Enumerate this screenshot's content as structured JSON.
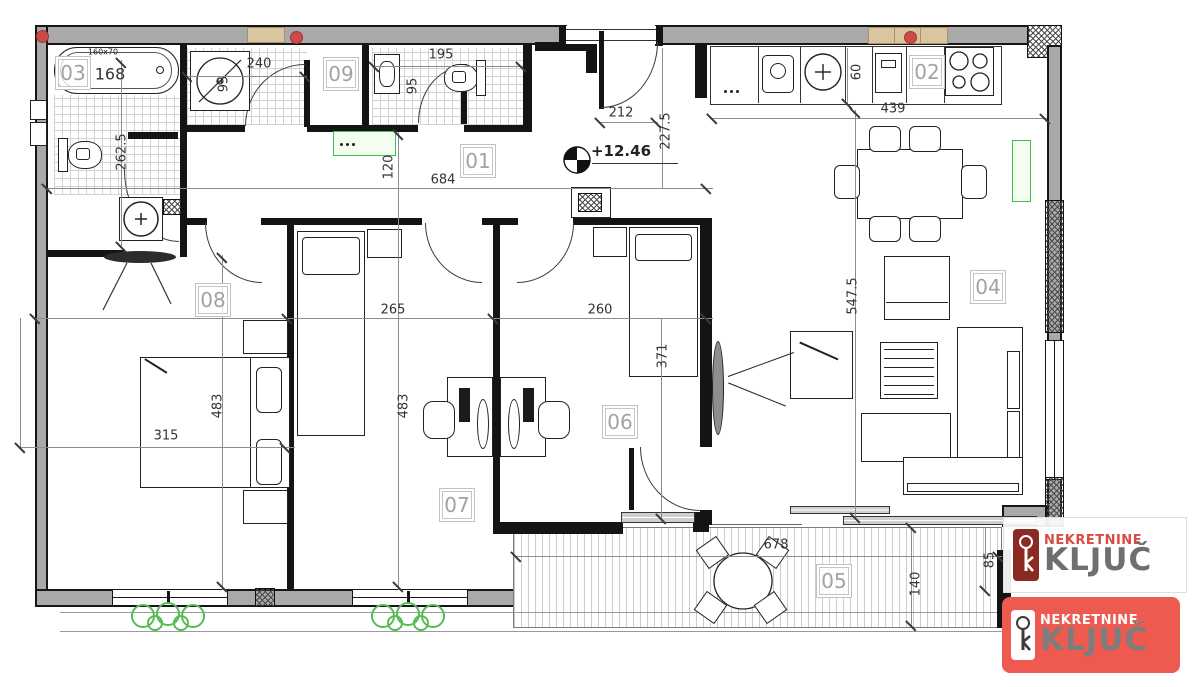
{
  "rooms": {
    "r1": "01",
    "r2": "02",
    "r3": "03",
    "r4": "04",
    "r5": "05",
    "r6": "06",
    "r7": "07",
    "r8": "08",
    "r9": "09"
  },
  "dims": {
    "bath_area": "168",
    "tub_size": "160x70",
    "bath_depth": "262.5",
    "closet_width": "240",
    "shower_width": "95",
    "wc_width": "195",
    "wc_depth": "95",
    "entry_width": "212",
    "entry_depth": "227.5",
    "level": "+12.46",
    "corridor_length": "684",
    "corridor_width": "120",
    "kitchen_length": "439",
    "kitchen_depth": "60",
    "room07_width": "265",
    "room06_width": "260",
    "room08_depth": "483",
    "room07_depth": "483",
    "room08_width": "315",
    "room06_depth": "371",
    "living_depth": "547.5",
    "terrace_length": "678",
    "terrace_depth": "140",
    "terrace_side": "85"
  },
  "logo": {
    "brand": "NEKRETNINE",
    "name": "KLJUČ"
  },
  "colors": {
    "logo_red": "#ee5a50",
    "brand_text_red": "#d84b42",
    "kljuc_gray": "#6f6f6f",
    "radiator_green": "#3fbf4e",
    "wall_gray": "#a9a9a9",
    "vent_red": "#cc4a4a",
    "wood_tan": "#d9c6a0"
  }
}
